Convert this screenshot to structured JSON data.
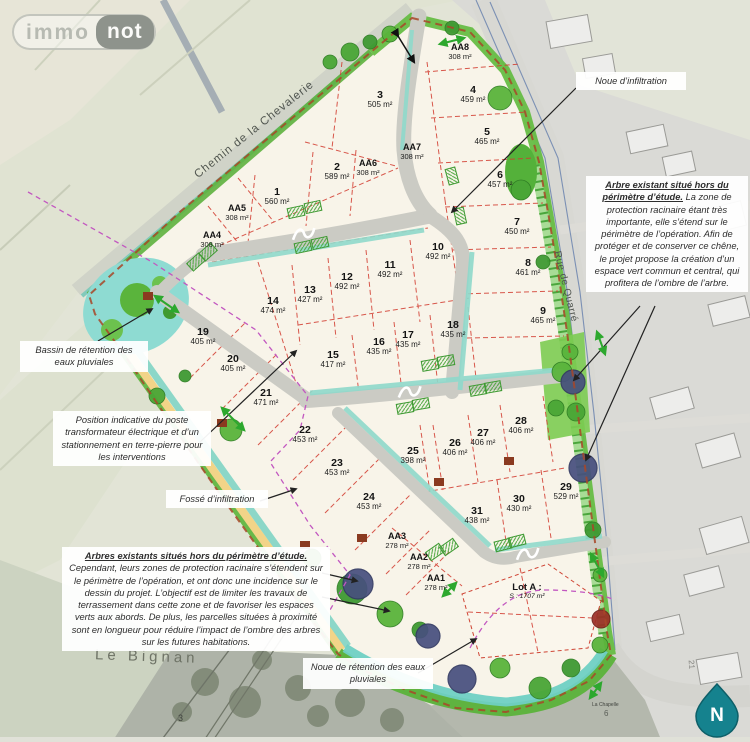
{
  "logo": {
    "immo": "immo",
    "not": "not"
  },
  "map": {
    "streets": {
      "chemin": "Chemin de la Chevalerie",
      "rue": "Rue de Quarré"
    },
    "places": {
      "hamlet": "Le Bignan",
      "chapelle": "La Chapelle",
      "chapelle_num": "6",
      "parcel_num": "3",
      "building_num": "21"
    },
    "north_label": "N",
    "lot_a": {
      "title": "Lot A :",
      "area": "S : 1707 m²"
    },
    "lots": [
      {
        "id": "1",
        "area": "560 m²",
        "x": 277,
        "y": 197
      },
      {
        "id": "2",
        "area": "589 m²",
        "x": 337,
        "y": 172
      },
      {
        "id": "3",
        "area": "505 m²",
        "x": 380,
        "y": 100
      },
      {
        "id": "4",
        "area": "459 m²",
        "x": 473,
        "y": 95
      },
      {
        "id": "5",
        "area": "465 m²",
        "x": 487,
        "y": 137
      },
      {
        "id": "6",
        "area": "457 m²",
        "x": 500,
        "y": 180
      },
      {
        "id": "7",
        "area": "450 m²",
        "x": 517,
        "y": 227
      },
      {
        "id": "8",
        "area": "461 m²",
        "x": 528,
        "y": 268
      },
      {
        "id": "9",
        "area": "465 m²",
        "x": 543,
        "y": 316
      },
      {
        "id": "10",
        "area": "492 m²",
        "x": 438,
        "y": 252
      },
      {
        "id": "11",
        "area": "492 m²",
        "x": 390,
        "y": 270
      },
      {
        "id": "12",
        "area": "492 m²",
        "x": 347,
        "y": 282
      },
      {
        "id": "13",
        "area": "427 m²",
        "x": 310,
        "y": 295
      },
      {
        "id": "14",
        "area": "474 m²",
        "x": 273,
        "y": 306
      },
      {
        "id": "15",
        "area": "417 m²",
        "x": 333,
        "y": 360
      },
      {
        "id": "16",
        "area": "435 m²",
        "x": 379,
        "y": 347
      },
      {
        "id": "17",
        "area": "435 m²",
        "x": 408,
        "y": 340
      },
      {
        "id": "18",
        "area": "435 m²",
        "x": 453,
        "y": 330
      },
      {
        "id": "19",
        "area": "405 m²",
        "x": 203,
        "y": 337
      },
      {
        "id": "20",
        "area": "405 m²",
        "x": 233,
        "y": 364
      },
      {
        "id": "21",
        "area": "471 m²",
        "x": 266,
        "y": 398
      },
      {
        "id": "22",
        "area": "453 m²",
        "x": 305,
        "y": 435
      },
      {
        "id": "23",
        "area": "453 m²",
        "x": 337,
        "y": 468
      },
      {
        "id": "24",
        "area": "453 m²",
        "x": 369,
        "y": 502
      },
      {
        "id": "25",
        "area": "398 m²",
        "x": 413,
        "y": 456
      },
      {
        "id": "26",
        "area": "406 m²",
        "x": 455,
        "y": 448
      },
      {
        "id": "27",
        "area": "406 m²",
        "x": 483,
        "y": 438
      },
      {
        "id": "28",
        "area": "406 m²",
        "x": 521,
        "y": 426
      },
      {
        "id": "29",
        "area": "529 m²",
        "x": 566,
        "y": 492
      },
      {
        "id": "30",
        "area": "430 m²",
        "x": 519,
        "y": 504
      },
      {
        "id": "31",
        "area": "438 m²",
        "x": 477,
        "y": 516
      },
      {
        "id": "AA1",
        "area": "278 m²",
        "x": 436,
        "y": 583
      },
      {
        "id": "AA2",
        "area": "278 m²",
        "x": 419,
        "y": 562
      },
      {
        "id": "AA3",
        "area": "278 m²",
        "x": 397,
        "y": 541
      },
      {
        "id": "AA4",
        "area": "308 m²",
        "x": 212,
        "y": 240
      },
      {
        "id": "AA5",
        "area": "308 m²",
        "x": 237,
        "y": 213
      },
      {
        "id": "AA6",
        "area": "308 m²",
        "x": 368,
        "y": 168
      },
      {
        "id": "AA7",
        "area": "308 m²",
        "x": 412,
        "y": 152
      },
      {
        "id": "AA8",
        "area": "308 m²",
        "x": 460,
        "y": 52
      }
    ],
    "annotations": [
      {
        "key": "noue-infiltration",
        "text": "Noue d’infiltration",
        "x": 576,
        "y": 72,
        "w": 100
      },
      {
        "key": "arbre-existant",
        "lead": "Arbre existant situé hors du périmètre d’étude.",
        "text": " La zone de protection racinaire étant très importante, elle s’étend sur le périmètre de l’opération. Afin de protéger et de conserver ce chêne, le projet propose la création d’un espace vert commun et central, qui profitera de l’ombre de l’arbre.",
        "x": 586,
        "y": 176,
        "w": 152
      },
      {
        "key": "bassin-retention",
        "text": "Bassin de rétention des eaux pluviales",
        "x": 20,
        "y": 341,
        "w": 118
      },
      {
        "key": "poste-transformateur",
        "text": "Position indicative du poste transformateur électrique et d’un stationnement en terre-pierre pour les interventions",
        "x": 53,
        "y": 411,
        "w": 148
      },
      {
        "key": "fosse-infiltration",
        "text": "Fossé d’infiltration",
        "x": 166,
        "y": 490,
        "w": 92
      },
      {
        "key": "arbres-existants",
        "lead": "Arbres existants situés hors du périmètre d’étude.",
        "text": " Cependant, leurs zones de protection racinaire s’étendent sur le périmètre de l’opération, et ont donc une incidence sur le dessin du projet. L’objectif est de limiter les travaux de terrassement dans cette zone et de favoriser les espaces verts aux abords. De plus, les parcelles situées à proximité sont en longueur pour réduire l’impact de l’ombre des arbres sur les futures habitations.",
        "x": 62,
        "y": 547,
        "w": 258
      },
      {
        "key": "noue-retention",
        "text": "Noue de rétention des eaux pluviales",
        "x": 303,
        "y": 658,
        "w": 120
      }
    ]
  }
}
